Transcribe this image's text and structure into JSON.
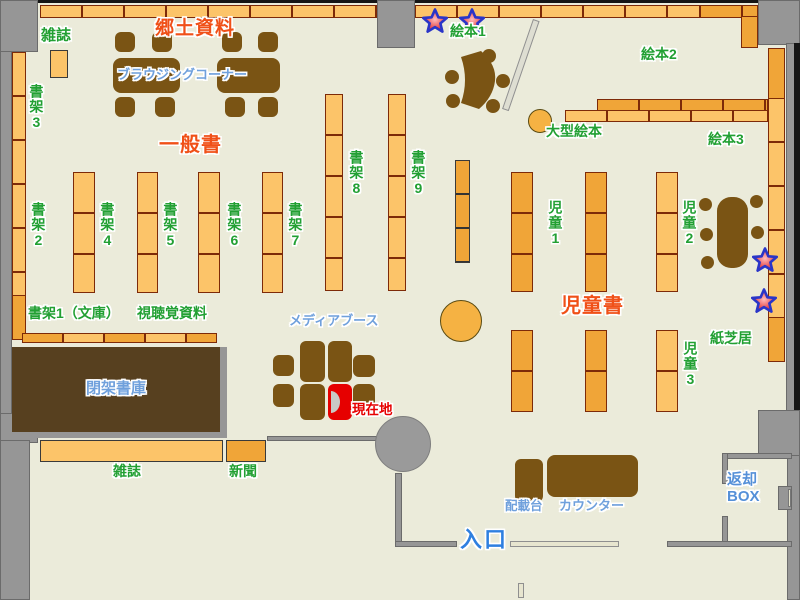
{
  "map_title": "library floor map",
  "colors": {
    "floor": "#EBEBDA",
    "wall": "#969696",
    "shelf_light": "#FCC469",
    "shelf_dark": "#F0A538",
    "furniture_brown": "#7A5414",
    "closed_stacks_brown": "#57401F",
    "label_green": "#22A033",
    "label_red_orange": "#F05018",
    "label_blue": "#6FA0DC",
    "entrance_blue": "#2E7FE0",
    "current_location_red": "#E60000",
    "star_fill": "#E23030",
    "star_outline": "#2A35C8"
  },
  "markers": {
    "star_count": 4
  },
  "labels": {
    "magazines_top": "雑誌",
    "shelf3": "書架3",
    "local_materials": "郷土資料",
    "browsing_corner": "ブラウジングコーナー",
    "general_books": "一般書",
    "shelf2": "書架2",
    "shelf4": "書架4",
    "shelf5": "書架5",
    "shelf6": "書架6",
    "shelf7": "書架7",
    "shelf8": "書架8",
    "shelf9": "書架9",
    "shelf1_bunko": "書架1（文庫）",
    "audiovisual": "視聴覚資料",
    "closed_stacks": "閉架書庫",
    "magazines_bottom": "雑誌",
    "newspaper": "新聞",
    "media_booth": "メディアブース",
    "current_location": "現在地",
    "picture_books1": "絵本1",
    "picture_books2": "絵本2",
    "picture_books3": "絵本3",
    "large_picture_books": "大型絵本",
    "children1": "児童1",
    "children2": "児童2",
    "children3": "児童3",
    "children_books": "児童書",
    "kamishibai": "紙芝居",
    "sorting_stand": "配載台",
    "counter": "カウンター",
    "entrance": "入口",
    "return_box": "返却\nBOX"
  }
}
